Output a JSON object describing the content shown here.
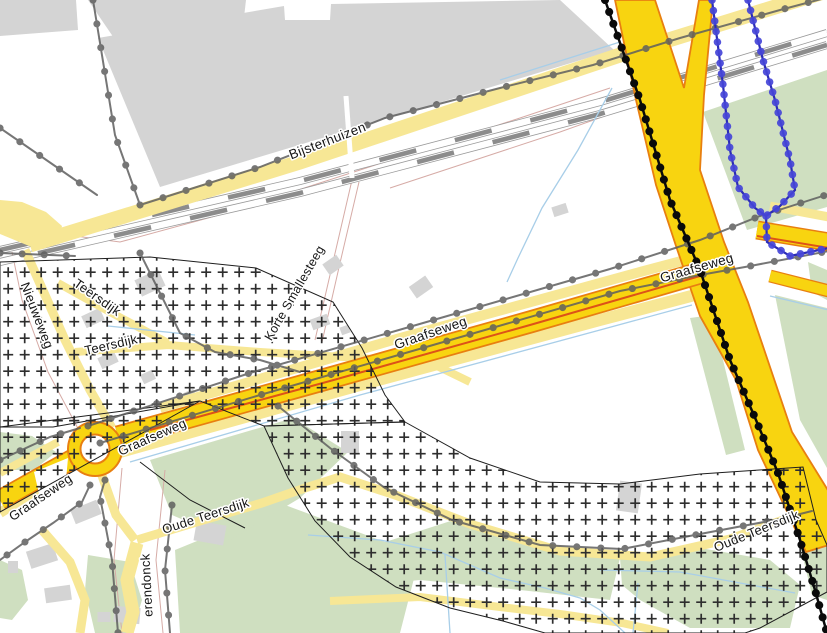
{
  "map": {
    "description": "Topographic / cadastral map extract with zoning hatch overlay (Graafseweg / Bijsterhuizen area)",
    "labels": [
      {
        "text": "Bijsterhuizen",
        "x": 329,
        "y": 145,
        "rot": -21,
        "size": 13.5
      },
      {
        "text": "Nieuweweg",
        "x": 33,
        "y": 317,
        "rot": 69,
        "size": 13
      },
      {
        "text": "Teersdijk",
        "x": 95,
        "y": 301,
        "rot": 35,
        "size": 13
      },
      {
        "text": "Teersdijk",
        "x": 112,
        "y": 349,
        "rot": -13,
        "size": 13
      },
      {
        "text": "Korte Smallesteeg",
        "x": 298,
        "y": 295,
        "rot": -60,
        "size": 12.5
      },
      {
        "text": "Graafseweg",
        "x": 432,
        "y": 337,
        "rot": -19,
        "size": 13.5
      },
      {
        "text": "Graafseweg",
        "x": 698,
        "y": 272,
        "rot": -16,
        "size": 13.5
      },
      {
        "text": "Graafseweg",
        "x": 154,
        "y": 441,
        "rot": -24,
        "size": 13
      },
      {
        "text": "Graafseweg",
        "x": 43,
        "y": 501,
        "rot": -34,
        "size": 13
      },
      {
        "text": "Oude Teersdijk",
        "x": 207,
        "y": 520,
        "rot": -18,
        "size": 13
      },
      {
        "text": "Oude Teersdijk",
        "x": 758,
        "y": 535,
        "rot": -22,
        "size": 13
      },
      {
        "text": "erendonck",
        "x": 151,
        "y": 585,
        "rot": -93,
        "size": 13
      }
    ],
    "colors": {
      "background": "#FFFFFF",
      "road_major": "#F8D410",
      "road_major_border": "#E87F10",
      "road_centerline": "#DD5218",
      "road_minor": "#F7E795",
      "vegetation": "#CFDFC0",
      "building": "#D4D4D4",
      "water": "#A8CEE8",
      "parcel_line": "#D6ABA6",
      "railway_dash": "#8C8C8C",
      "railway_edge": "#9A9A9A",
      "boundary_gray": "#5F5F5F",
      "boundary_black": "#0A0A0A",
      "boundary_blue": "#4646D8",
      "boundary_blue_line": "#2B2BB4",
      "zone_hatch": "#2E2E2E",
      "zone_border": "#1E1E1E",
      "label": "#151515"
    }
  }
}
